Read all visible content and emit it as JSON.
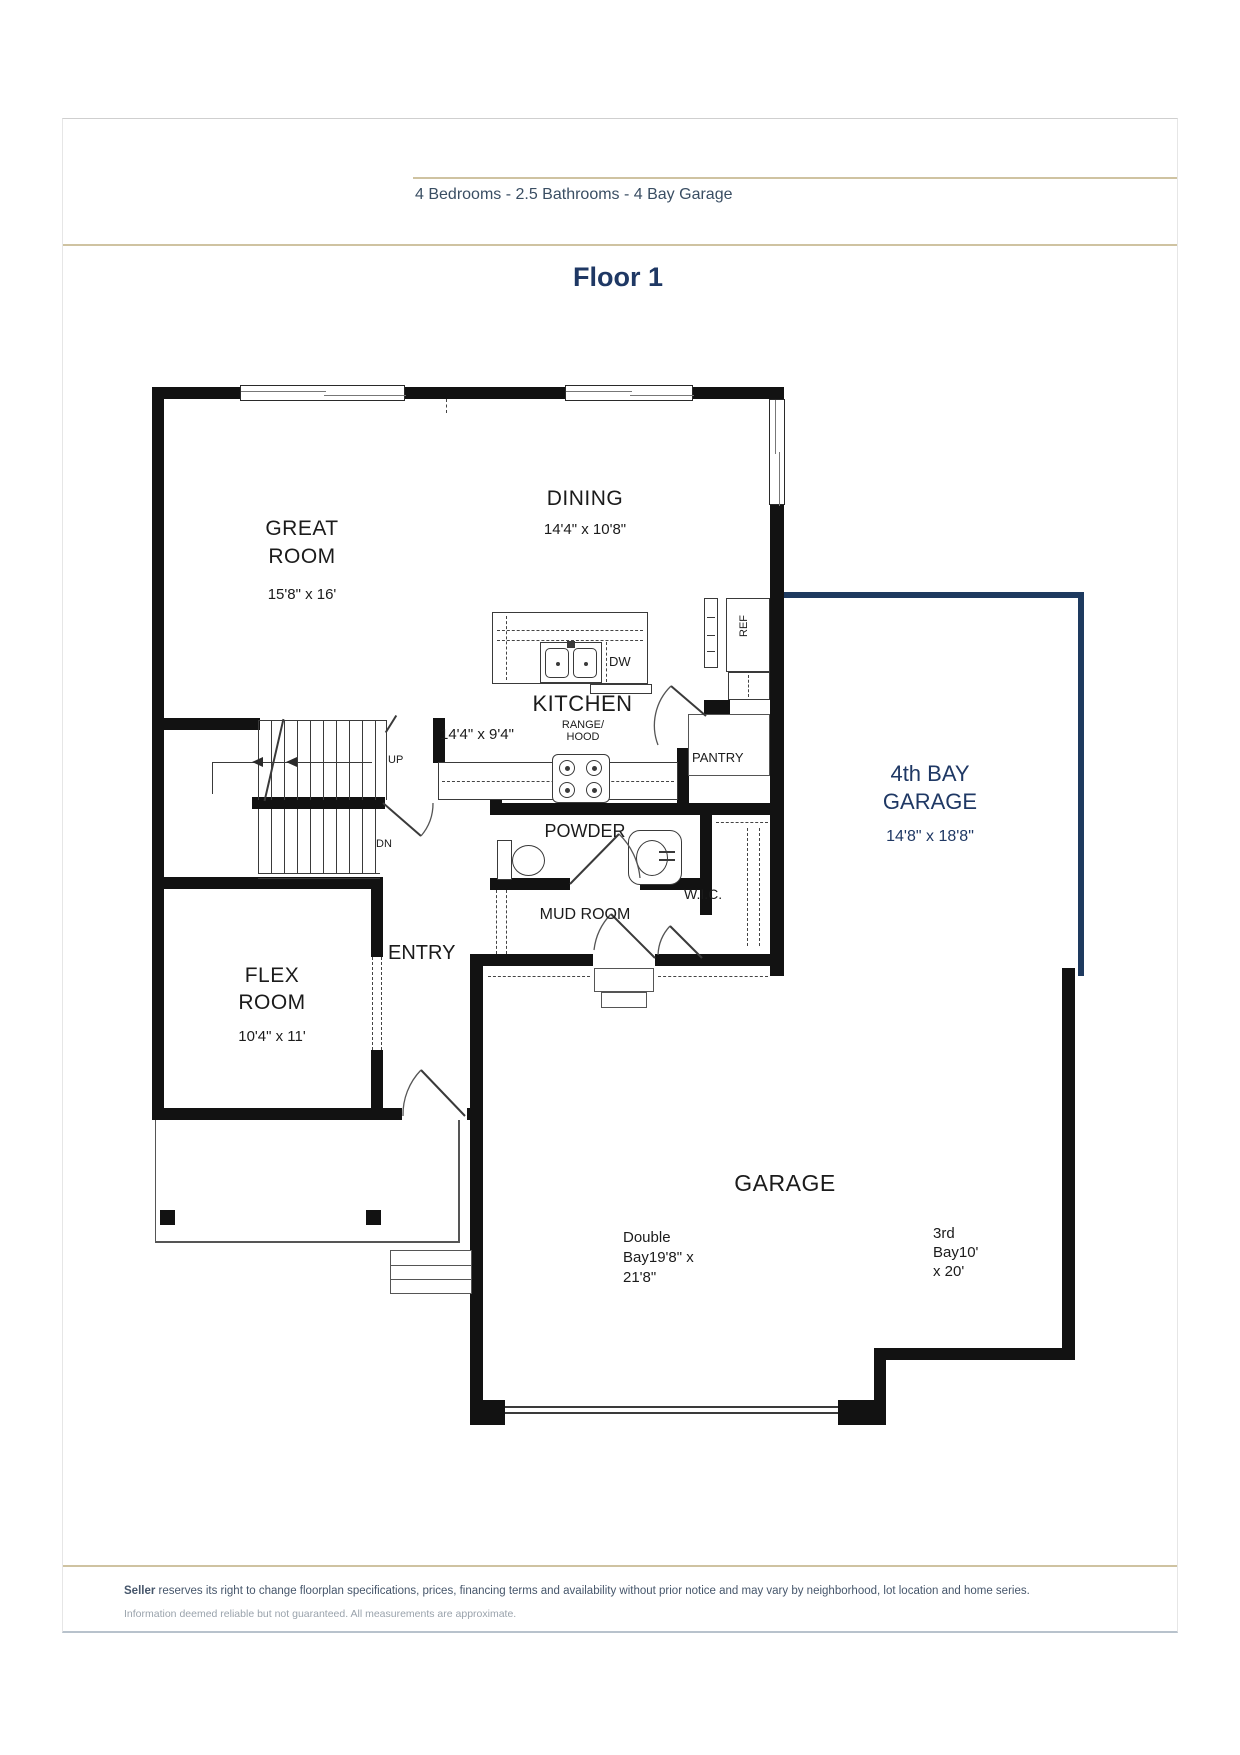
{
  "header": {
    "summary": "4 Bedrooms - 2.5 Bathrooms - 4 Bay Garage"
  },
  "title": "Floor 1",
  "plan": {
    "rooms": {
      "great": {
        "l1": "GREAT",
        "l2": "ROOM",
        "dims": "15'8\" x 16'"
      },
      "dining": {
        "l1": "DINING",
        "dims": "14'4\" x 10'8\""
      },
      "kitchen": {
        "l1": "KITCHEN",
        "dims": "14'4\" x 9'4\""
      },
      "flex": {
        "l1": "FLEX",
        "l2": "ROOM",
        "dims": "10'4\" x 11'"
      },
      "powder": "POWDER",
      "mud": "MUD ROOM",
      "entry": "ENTRY",
      "wic": "W.I.C.",
      "pantry": "PANTRY",
      "garage": "GARAGE",
      "fourth_bay": {
        "l1": "4th BAY",
        "l2": "GARAGE",
        "dims": "14'8\" x 18'8\""
      },
      "double_bay": {
        "l1": "Double",
        "l2": "Bay19'8\" x",
        "l3": "21'8\""
      },
      "third_bay": {
        "l1": "3rd",
        "l2": "Bay10'",
        "l3": "x 20'"
      }
    },
    "labels": {
      "up": "UP",
      "dn": "DN",
      "dw": "DW",
      "ref": "REF",
      "range1": "RANGE/",
      "range2": "HOOD"
    }
  },
  "footer": {
    "lead": "Seller",
    "line1": "reserves its right to change floorplan specifications, prices, financing terms and availability without prior notice and may vary by neighborhood, lot location and home series.",
    "line2": "Information deemed reliable but not guaranteed.  All measurements are approximate."
  },
  "colors": {
    "accent": "#1f3864",
    "tan": "#cfc3a1",
    "wall": "#121212"
  }
}
